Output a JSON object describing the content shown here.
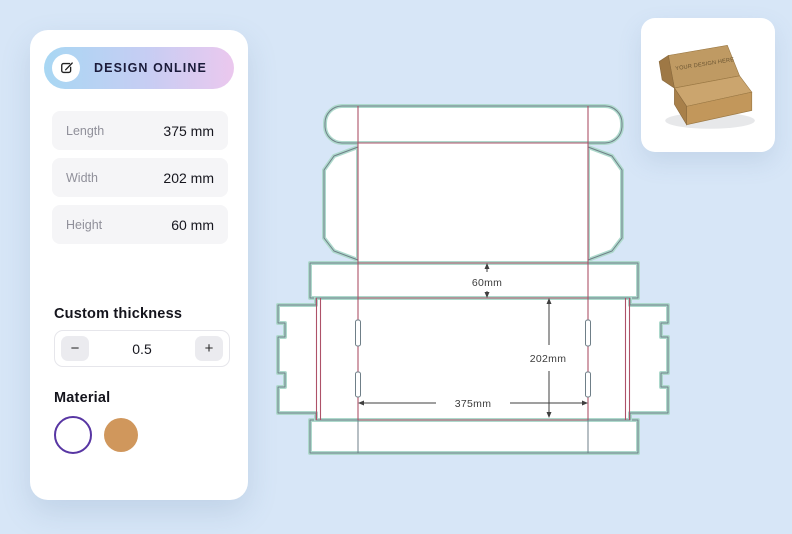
{
  "app": {
    "background_color": "#d7e6f7",
    "accent_gradient": [
      "#a8d7f3",
      "#ebc8ee"
    ]
  },
  "sidebar": {
    "cta": {
      "label": "DESIGN ONLINE",
      "icon": "edit-icon"
    },
    "fields": [
      {
        "label": "Length",
        "value": "375 mm"
      },
      {
        "label": "Width",
        "value": "202 mm"
      },
      {
        "label": "Height",
        "value": "60 mm"
      }
    ],
    "thickness": {
      "label": "Custom thickness",
      "decrement": "−",
      "value": "0.5",
      "increment": "+"
    },
    "material": {
      "label": "Material",
      "swatches": [
        {
          "name": "white",
          "fill": "#ffffff",
          "ring": "#5836a3"
        },
        {
          "name": "kraft",
          "fill": "#d0975c"
        }
      ]
    }
  },
  "dieline": {
    "dimensions": {
      "height_label": "60mm",
      "width_label": "202mm",
      "length_label": "375mm"
    },
    "colors": {
      "cut_outline": "#aed9cc",
      "cut_edge": "#6f7f88",
      "crease": "#ae5268",
      "dimension": "#3c3c3c",
      "panel": "#ffffff"
    }
  },
  "preview": {
    "box_text": "YOUR DESIGN HERE"
  }
}
